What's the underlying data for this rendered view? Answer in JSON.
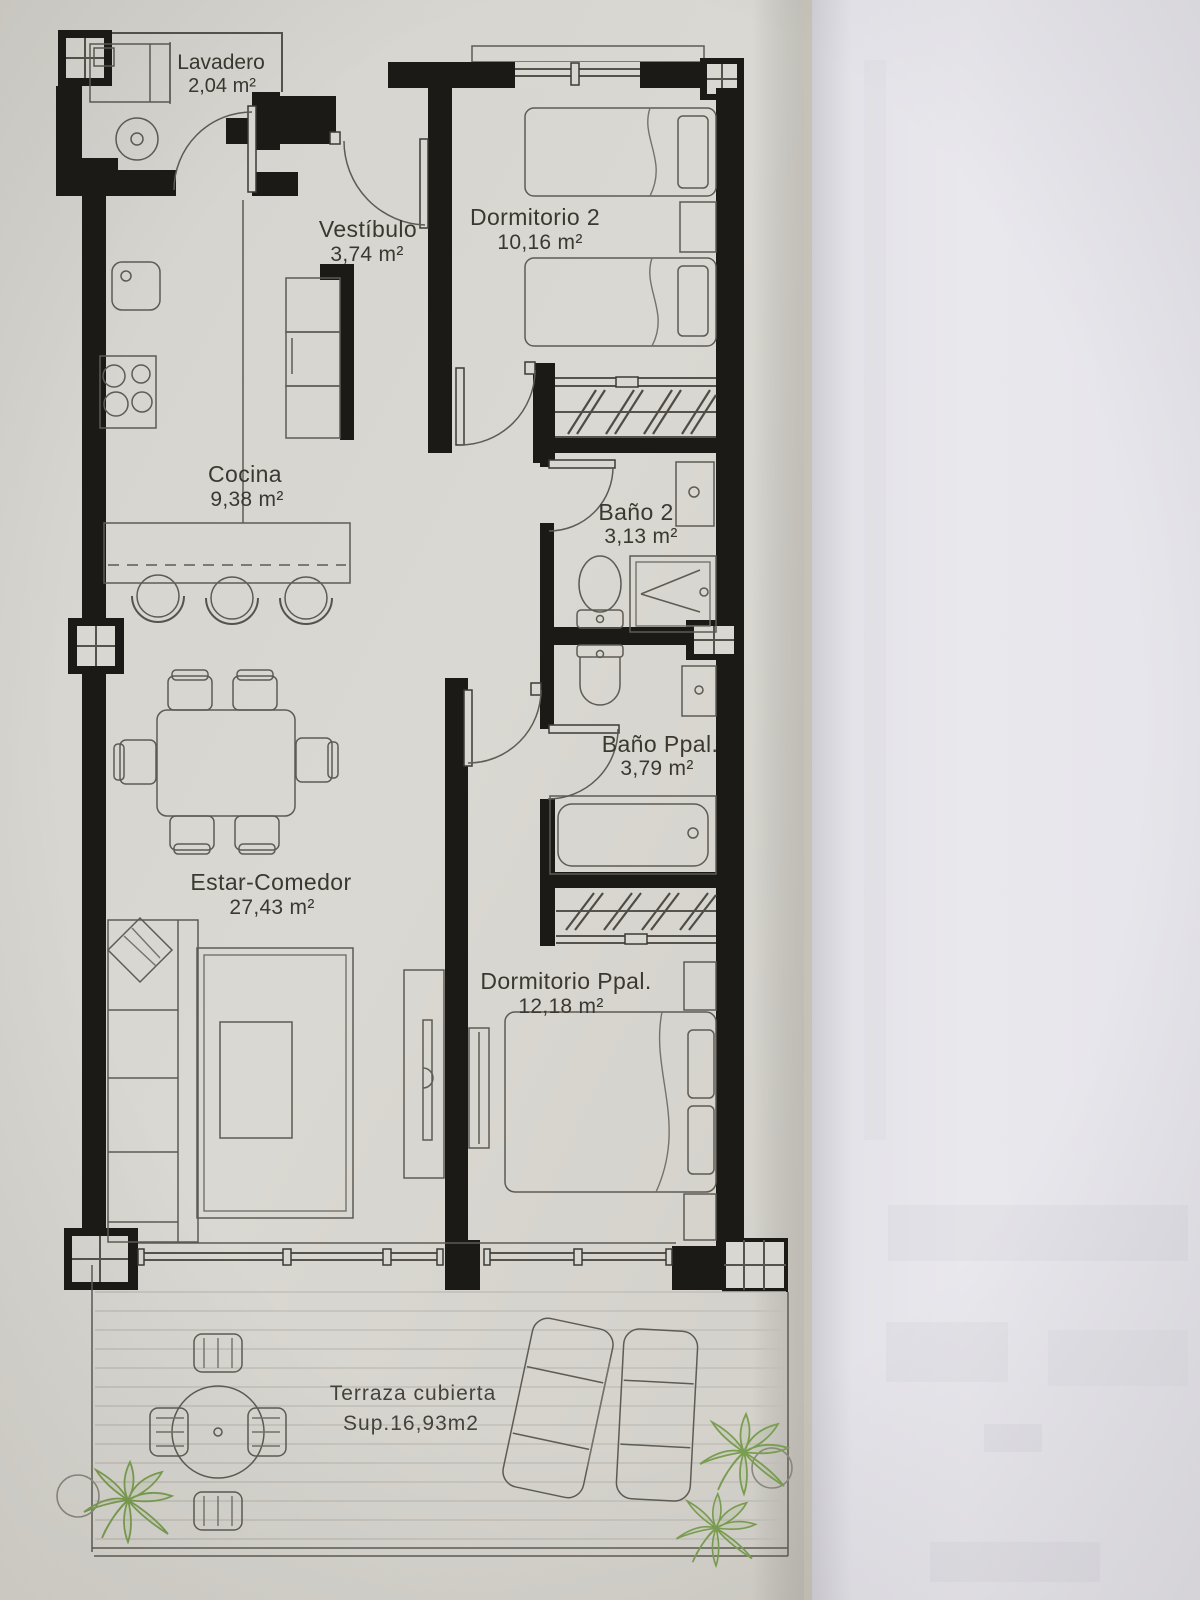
{
  "document": {
    "kind": "apartment floor plan photo",
    "sheet": "printed plan on grey paper, second white sheet on the right"
  },
  "rooms": [
    {
      "id": "lavadero",
      "name": "Lavadero",
      "area": "2,04 m²"
    },
    {
      "id": "vestibulo",
      "name": "Vestíbulo",
      "area": "3,74 m²"
    },
    {
      "id": "dormitorio2",
      "name": "Dormitorio 2",
      "area": "10,16 m²"
    },
    {
      "id": "cocina",
      "name": "Cocina",
      "area": "9,38 m²"
    },
    {
      "id": "bano2",
      "name": "Baño 2",
      "area": "3,13 m²"
    },
    {
      "id": "banoppal",
      "name": "Baño Ppal.",
      "area": "3,79 m²"
    },
    {
      "id": "estar",
      "name": "Estar-Comedor",
      "area": "27,43 m²"
    },
    {
      "id": "dormppal",
      "name": "Dormitorio Ppal.",
      "area": "12,18 m²"
    },
    {
      "id": "terraza",
      "name": "Terraza  cubierta",
      "area": "Sup.16,93m2"
    }
  ],
  "colors": {
    "paper": "#d8d6d0",
    "second_sheet": "#e8e7ec",
    "wall_ink": "#1b1a17",
    "line_ink": "#55534b",
    "plant_green": "#7b9e52",
    "label_ink": "#3a382f"
  }
}
